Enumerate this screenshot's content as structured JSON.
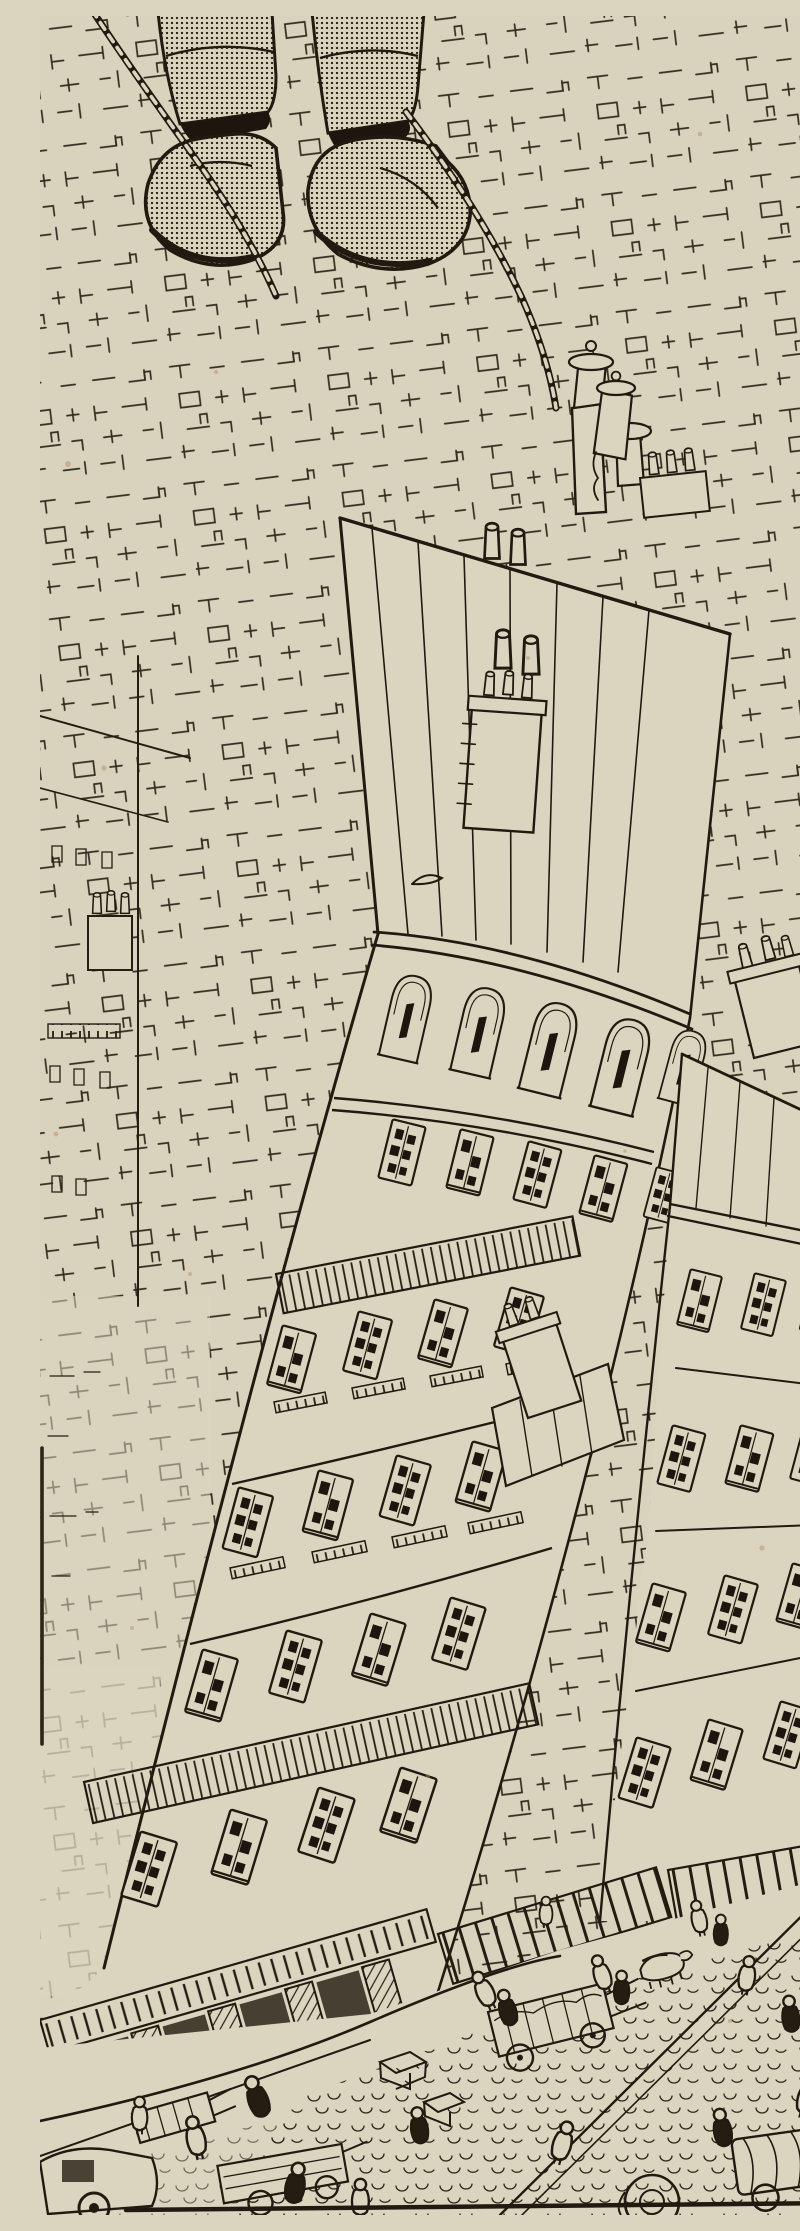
{
  "artwork": {
    "title": "Bird's-eye view from a swing above the city",
    "medium": "pen-and-ink line illustration with halftone stipple on cream paper",
    "description": "View straight down past a seated figure's stippled boots and braided swing ropes onto the roof and facade of a tall apartment building, a sea of scribbled rooftops and chimney pots, neighbouring buildings, striped shop awnings, and a cobbled street crowded with tiny pedestrians, crates, hand-carts, a horse cart and early motor cars.",
    "palette": {
      "paper": "#dbd5c0",
      "ink": "#211a10",
      "foxing": "#b5845e"
    },
    "scene": {
      "foreground": [
        "trouser cuffs",
        "stippled boots",
        "braided swing ropes"
      ],
      "midground": [
        "rooftop scribble field",
        "tall chimney with capped pot",
        "chimney-pot clusters",
        "main building roof with seams",
        "cornice",
        "arched window floor",
        "five floors of shuttered windows",
        "balcony railings",
        "shopfront with pilasters and frieze"
      ],
      "right_side": [
        "neighbour building with window rows",
        "roof chimney stack",
        "small gap roof with chimney",
        "striped awnings"
      ],
      "street": [
        "double curb lines",
        "cobblestones",
        "pedestrians seen from above",
        "crates",
        "hand-cart",
        "horse cart",
        "round-roofed car",
        "canopied truck",
        "motor car"
      ],
      "details": [
        "foxing specks",
        "dark plate-edge line lower left",
        "dark base line at bottom"
      ]
    }
  }
}
